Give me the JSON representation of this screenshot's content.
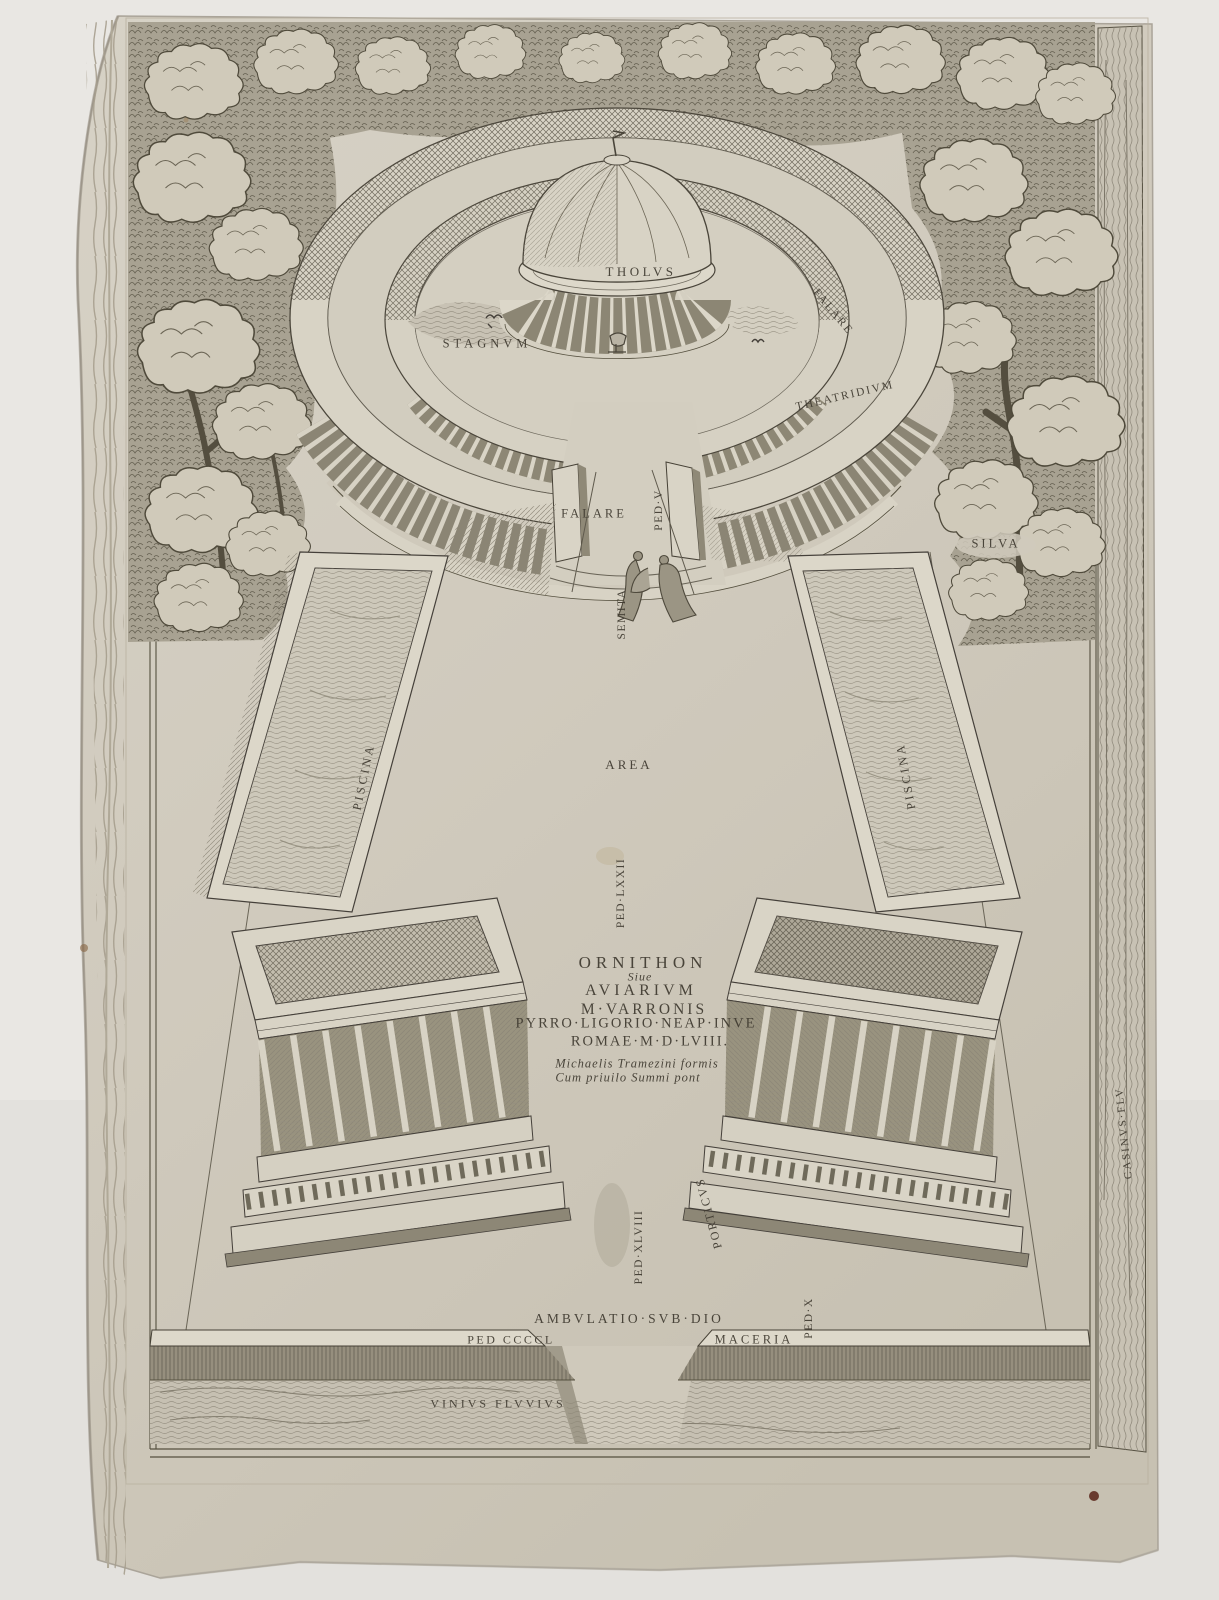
{
  "artwork_type": "engraved architectural print",
  "colors": {
    "backdrop": "#e9e7e3",
    "paper": "#d0cabd",
    "paper_light": "#dad5c8",
    "ink": "#403b31",
    "ink_light": "#6e695d",
    "stain": "#5e2c20"
  },
  "title_block": {
    "ornithon": "ORNITHON",
    "sive": "Siue",
    "aviarium": "AVIARIVM",
    "varronis": "M·VARRONIS",
    "ligorio": "PYRRO·LIGORIO·NEAP·INVE",
    "romae": "ROMAE·M·D·LVIII.",
    "imprint_1": "Michaelis Tramezini formis",
    "imprint_2": "Cum priuilo Summi pont"
  },
  "labels": {
    "tholus": "THOLVS",
    "stagnum": "STAGNVM",
    "falare_upper": "FALARE",
    "theatridium": "THEATRIDIVM",
    "falare_lower": "FALARE",
    "ped_v": "PED·V",
    "semita": "SEMITA",
    "silva": "SILVA",
    "piscina_left": "PISCINA",
    "area": "AREA",
    "piscina_right": "PISCINA",
    "ped_lxxii": "PED·LXXII",
    "ped_xlviii": "PED·XLVIII",
    "porticus": "PORTICVS",
    "ped_x": "PED·X",
    "ambulatio": "AMBVLATIO·SVB·DIO",
    "ped_ccccl": "PED CCCCL",
    "maceria": "MACERIA",
    "vinius_fluvius": "VINIVS FLVVIVS",
    "casinus_flu": "CASINVS·FLV"
  }
}
